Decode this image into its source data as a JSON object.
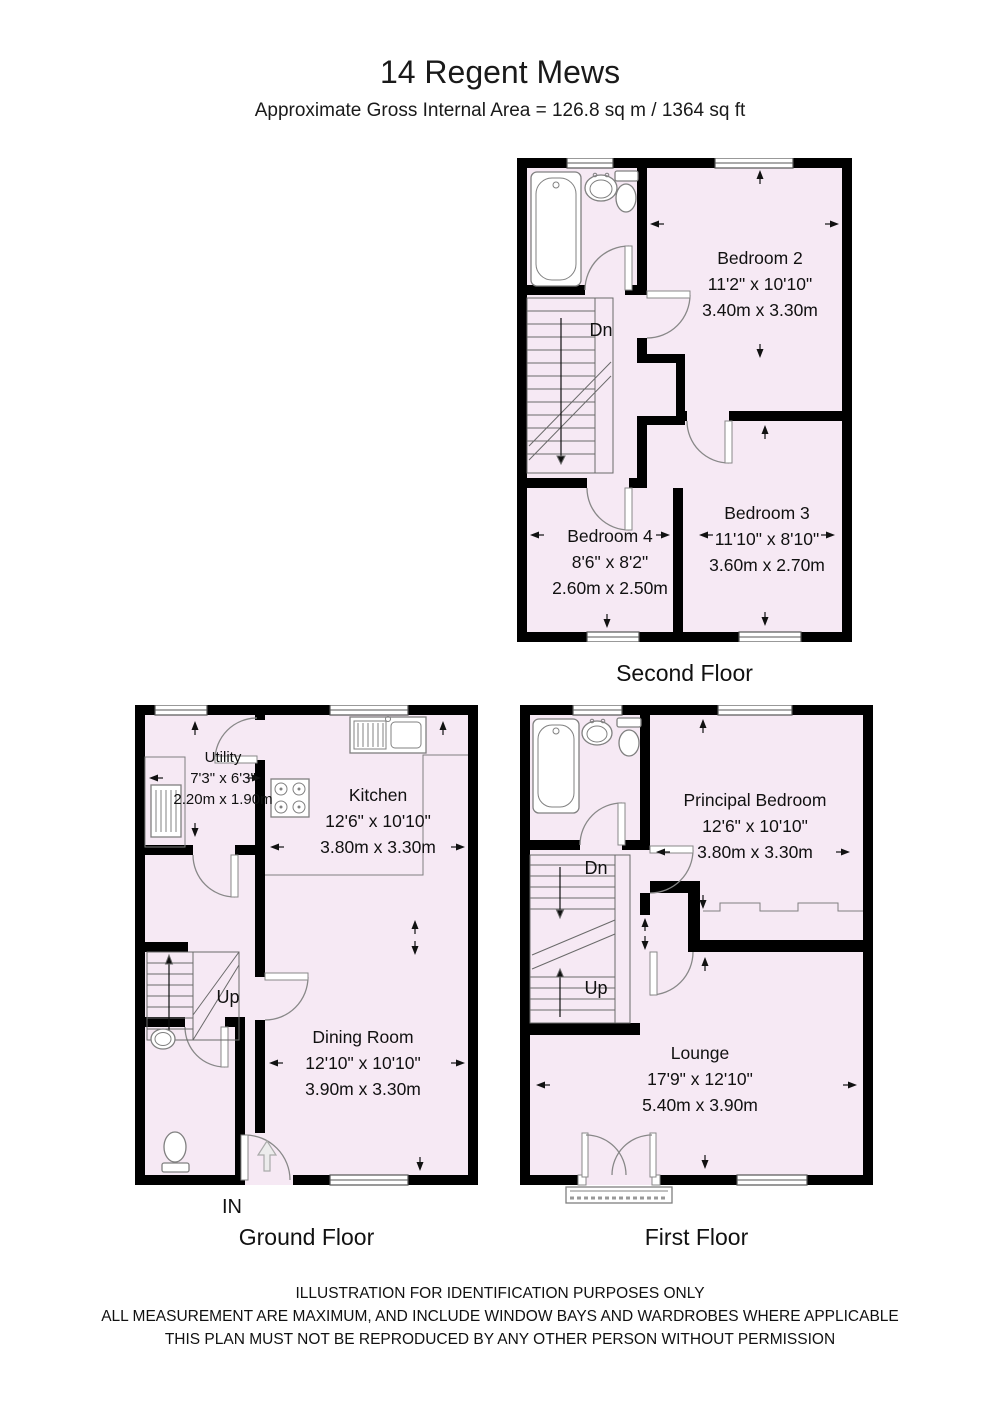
{
  "header": {
    "title": "14 Regent Mews",
    "subtitle": "Approximate Gross Internal Area = 126.8 sq m / 1364 sq ft"
  },
  "floors": {
    "second": {
      "label": "Second Floor",
      "stairs": "Dn",
      "bedroom2": {
        "name": "Bedroom 2",
        "imperial": "11'2\" x 10'10\"",
        "metric": "3.40m x 3.30m"
      },
      "bedroom3": {
        "name": "Bedroom 3",
        "imperial": "11'10\" x 8'10\"",
        "metric": "3.60m x 2.70m"
      },
      "bedroom4": {
        "name": "Bedroom 4",
        "imperial": "8'6\" x 8'2\"",
        "metric": "2.60m x 2.50m"
      }
    },
    "ground": {
      "label": "Ground Floor",
      "stairs": "Up",
      "entrance": "IN",
      "utility": {
        "name": "Utility",
        "imperial": "7'3\" x 6'3\"",
        "metric": "2.20m x 1.90m"
      },
      "kitchen": {
        "name": "Kitchen",
        "imperial": "12'6\" x 10'10\"",
        "metric": "3.80m x 3.30m"
      },
      "dining": {
        "name": "Dining Room",
        "imperial": "12'10\" x 10'10\"",
        "metric": "3.90m x 3.30m"
      }
    },
    "first": {
      "label": "First Floor",
      "stairs_down": "Dn",
      "stairs_up": "Up",
      "principal": {
        "name": "Principal Bedroom",
        "imperial": "12'6\" x 10'10\"",
        "metric": "3.80m x 3.30m"
      },
      "lounge": {
        "name": "Lounge",
        "imperial": "17'9\" x 12'10\"",
        "metric": "5.40m x 3.90m"
      }
    }
  },
  "footer": {
    "line1": "ILLUSTRATION FOR IDENTIFICATION PURPOSES ONLY",
    "line2": "ALL MEASUREMENT  ARE MAXIMUM, AND INCLUDE WINDOW BAYS AND WARDROBES WHERE APPLICABLE",
    "line3": "THIS PLAN MUST NOT BE REPRODUCED BY ANY OTHER PERSON WITHOUT PERMISSION"
  },
  "colors": {
    "room_fill": "#f6e9f4",
    "wall": "#000000",
    "line": "#808080"
  }
}
